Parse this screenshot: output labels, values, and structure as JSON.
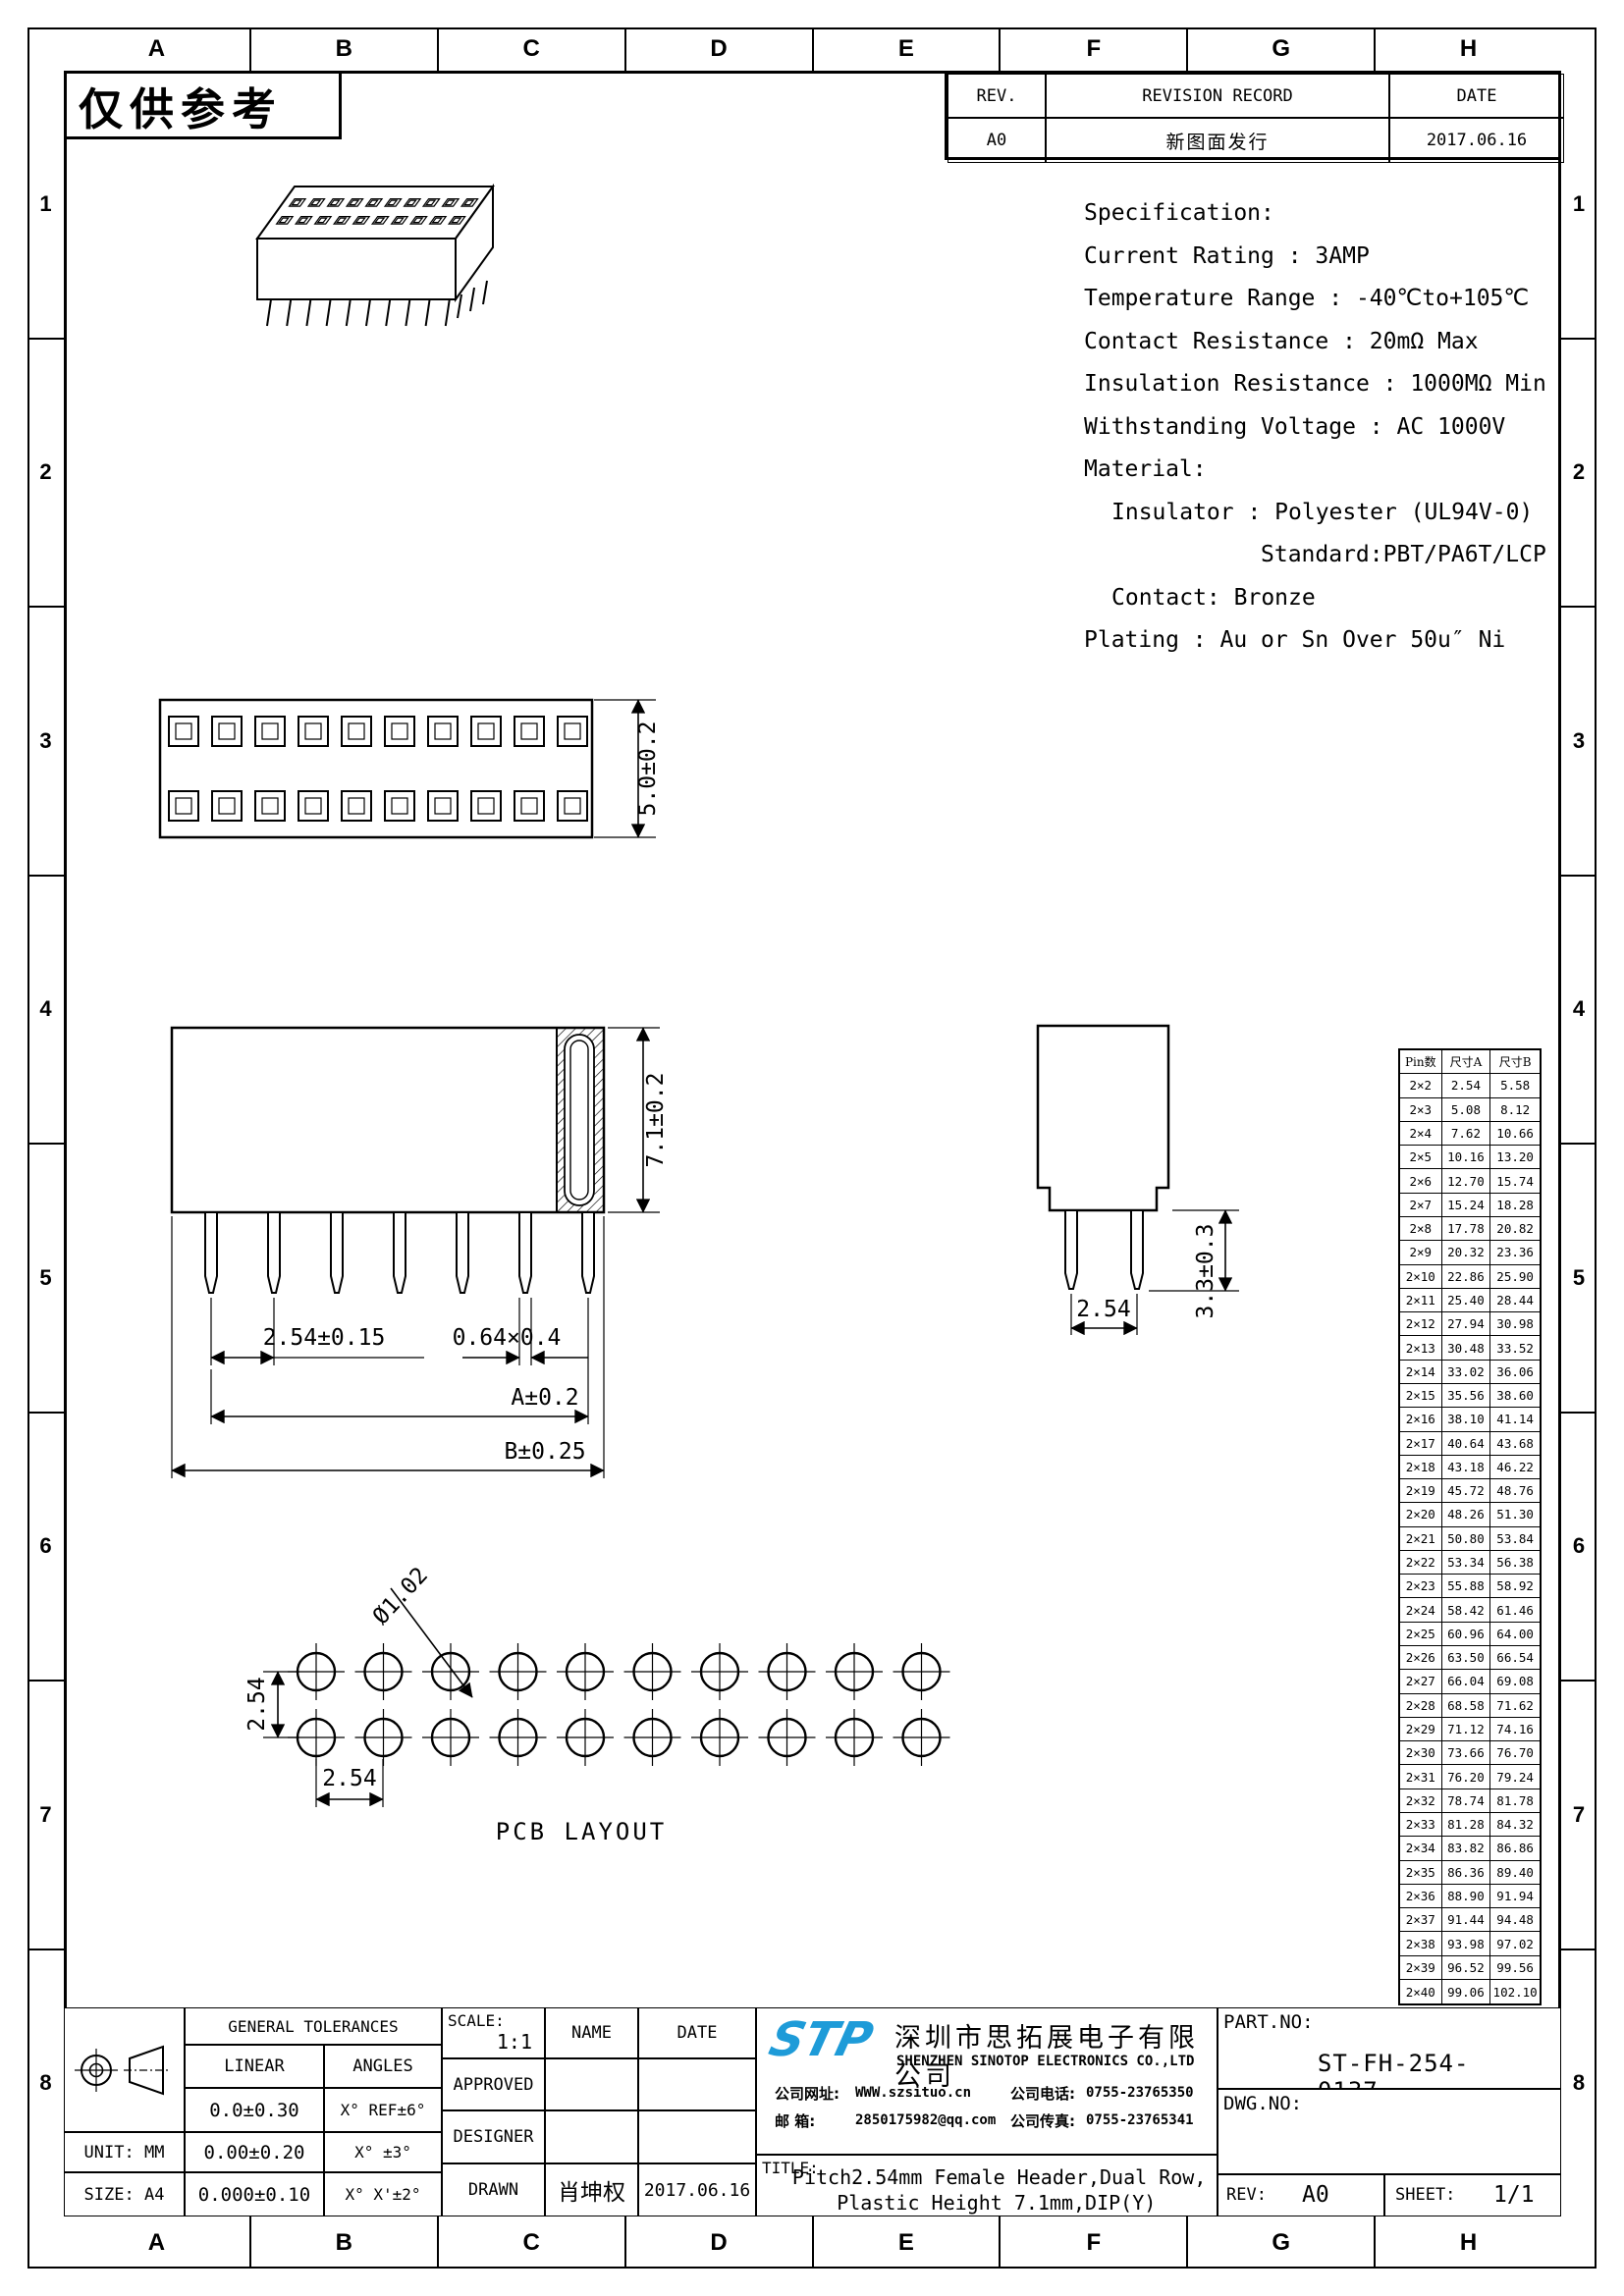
{
  "sheet": {
    "watermark": "仅供参考"
  },
  "border": {
    "columns": [
      "A",
      "B",
      "C",
      "D",
      "E",
      "F",
      "G",
      "H"
    ],
    "rows": [
      "1",
      "2",
      "3",
      "4",
      "5",
      "6",
      "7",
      "8"
    ]
  },
  "revision": {
    "rev_header": "REV.",
    "record_header": "REVISION RECORD",
    "date_header": "DATE",
    "rev": "A0",
    "record": "新图面发行",
    "date": "2017.06.16"
  },
  "specification": {
    "lines": [
      {
        "text": "Specification:",
        "indent": 0
      },
      {
        "text": "Current Rating : 3AMP",
        "indent": 0
      },
      {
        "text": "Temperature Range : -40℃to+105℃",
        "indent": 0
      },
      {
        "text": "Contact Resistance : 20mΩ Max",
        "indent": 0
      },
      {
        "text": "Insulation Resistance : 1000MΩ Min",
        "indent": 0
      },
      {
        "text": "Withstanding Voltage : AC 1000V",
        "indent": 0
      },
      {
        "text": "Material:",
        "indent": 0
      },
      {
        "text": "Insulator : Polyester (UL94V-0)",
        "indent": 1
      },
      {
        "text": "Standard:PBT/PA6T/LCP",
        "indent": 2
      },
      {
        "text": "Contact: Bronze",
        "indent": 1
      },
      {
        "text": "Plating : Au or Sn Over 50u″ Ni",
        "indent": 0
      }
    ]
  },
  "drawing_labels": {
    "top_height": "5.0±0.2",
    "body_height": "7.1±0.2",
    "pitch": "2.54±0.15",
    "pin_cross": "0.64×0.4",
    "dim_a": "A±0.2",
    "dim_b": "B±0.25",
    "side_pitch": "2.54",
    "pin_length": "3.3±0.3",
    "hole_dia": "Ø1.02",
    "pcb_row_pitch": "2.54",
    "pcb_col_pitch": "2.54",
    "pcb_caption": "PCB LAYOUT"
  },
  "dim_table": {
    "headers": [
      "Pin数",
      "尺寸A",
      "尺寸B"
    ],
    "rows": [
      [
        "2×2",
        "2.54",
        "5.58"
      ],
      [
        "2×3",
        "5.08",
        "8.12"
      ],
      [
        "2×4",
        "7.62",
        "10.66"
      ],
      [
        "2×5",
        "10.16",
        "13.20"
      ],
      [
        "2×6",
        "12.70",
        "15.74"
      ],
      [
        "2×7",
        "15.24",
        "18.28"
      ],
      [
        "2×8",
        "17.78",
        "20.82"
      ],
      [
        "2×9",
        "20.32",
        "23.36"
      ],
      [
        "2×10",
        "22.86",
        "25.90"
      ],
      [
        "2×11",
        "25.40",
        "28.44"
      ],
      [
        "2×12",
        "27.94",
        "30.98"
      ],
      [
        "2×13",
        "30.48",
        "33.52"
      ],
      [
        "2×14",
        "33.02",
        "36.06"
      ],
      [
        "2×15",
        "35.56",
        "38.60"
      ],
      [
        "2×16",
        "38.10",
        "41.14"
      ],
      [
        "2×17",
        "40.64",
        "43.68"
      ],
      [
        "2×18",
        "43.18",
        "46.22"
      ],
      [
        "2×19",
        "45.72",
        "48.76"
      ],
      [
        "2×20",
        "48.26",
        "51.30"
      ],
      [
        "2×21",
        "50.80",
        "53.84"
      ],
      [
        "2×22",
        "53.34",
        "56.38"
      ],
      [
        "2×23",
        "55.88",
        "58.92"
      ],
      [
        "2×24",
        "58.42",
        "61.46"
      ],
      [
        "2×25",
        "60.96",
        "64.00"
      ],
      [
        "2×26",
        "63.50",
        "66.54"
      ],
      [
        "2×27",
        "66.04",
        "69.08"
      ],
      [
        "2×28",
        "68.58",
        "71.62"
      ],
      [
        "2×29",
        "71.12",
        "74.16"
      ],
      [
        "2×30",
        "73.66",
        "76.70"
      ],
      [
        "2×31",
        "76.20",
        "79.24"
      ],
      [
        "2×32",
        "78.74",
        "81.78"
      ],
      [
        "2×33",
        "81.28",
        "84.32"
      ],
      [
        "2×34",
        "83.82",
        "86.86"
      ],
      [
        "2×35",
        "86.36",
        "89.40"
      ],
      [
        "2×36",
        "88.90",
        "91.94"
      ],
      [
        "2×37",
        "91.44",
        "94.48"
      ],
      [
        "2×38",
        "93.98",
        "97.02"
      ],
      [
        "2×39",
        "96.52",
        "99.56"
      ],
      [
        "2×40",
        "99.06",
        "102.10"
      ]
    ]
  },
  "title_block": {
    "tolerances": {
      "header": "GENERAL TOLERANCES",
      "linear": "LINEAR",
      "angles": "ANGLES",
      "rows": [
        [
          "0.0±0.30",
          "X° REF±6°"
        ],
        [
          "0.00±0.20",
          "X° ±3°"
        ],
        [
          "0.000±0.10",
          "X° X'±2°"
        ]
      ],
      "unit": "UNIT: MM",
      "size": "SIZE: A4"
    },
    "approval": {
      "scale_label": "SCALE:",
      "scale": "1:1",
      "name": "NAME",
      "date": "DATE",
      "approved": "APPROVED",
      "designer": "DESIGNER",
      "drawn": "DRAWN",
      "drawn_name": "肖坤权",
      "drawn_date": "2017.06.16"
    },
    "company": {
      "logo": "STP",
      "logo_color": "#1e9bd8",
      "cn": "深圳市思拓展电子有限公司",
      "en": "SHENZHEN SINOTOP ELECTRONICS CO.,LTD",
      "site_label": "公司网址:",
      "site": "WWW.szsituo.cn",
      "mail_label": "邮  箱:",
      "mail": "2850175982@qq.com",
      "tel_label": "公司电话:",
      "tel": "0755-23765350",
      "fax_label": "公司传真:",
      "fax": "0755-23765341"
    },
    "title": {
      "label": "TITLE:",
      "line1": "Pitch2.54mm Female Header,Dual Row,",
      "line2": "Plastic Height 7.1mm,DIP(Y)"
    },
    "part": {
      "label": "PART.NO:",
      "value": "ST-FH-254-0137"
    },
    "dwg": {
      "label": "DWG.NO:"
    },
    "rev": {
      "label": "REV:",
      "value": "A0"
    },
    "sheet_no": {
      "label": "SHEET:",
      "value": "1/1"
    }
  }
}
